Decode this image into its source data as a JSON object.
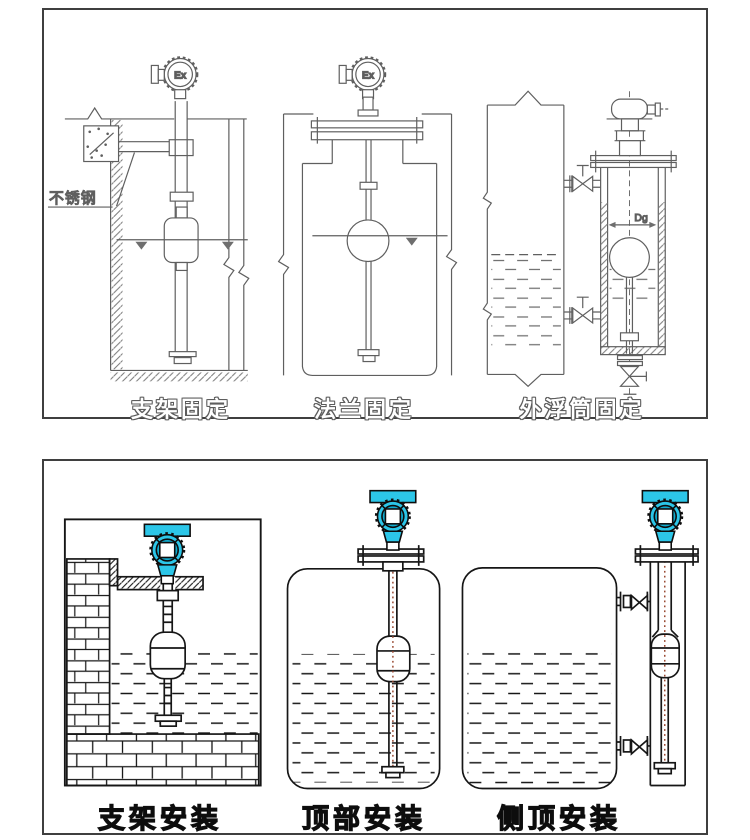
{
  "colors": {
    "top_line": "#5f5f5f",
    "bottom_line": "#161616",
    "transmitter_head": "#2cc6e8",
    "transmitter_head_dark": "#10aacd",
    "float_center_line": "#9a4a33",
    "panel_border": "#3f3f3f",
    "background": "#ffffff"
  },
  "top_panel": {
    "diagrams": [
      {
        "caption": "支架固定",
        "annotations": {
          "material_label": "不锈钢",
          "ex_mark": "Ex"
        }
      },
      {
        "caption": "法兰固定",
        "annotations": {
          "ex_mark": "Ex"
        }
      },
      {
        "caption": "外浮筒固定",
        "annotations": {
          "diameter_label": "Dg"
        }
      }
    ]
  },
  "bottom_panel": {
    "diagrams": [
      {
        "caption": "支架安装"
      },
      {
        "caption": "顶部安装"
      },
      {
        "caption": "侧顶安装"
      }
    ]
  }
}
